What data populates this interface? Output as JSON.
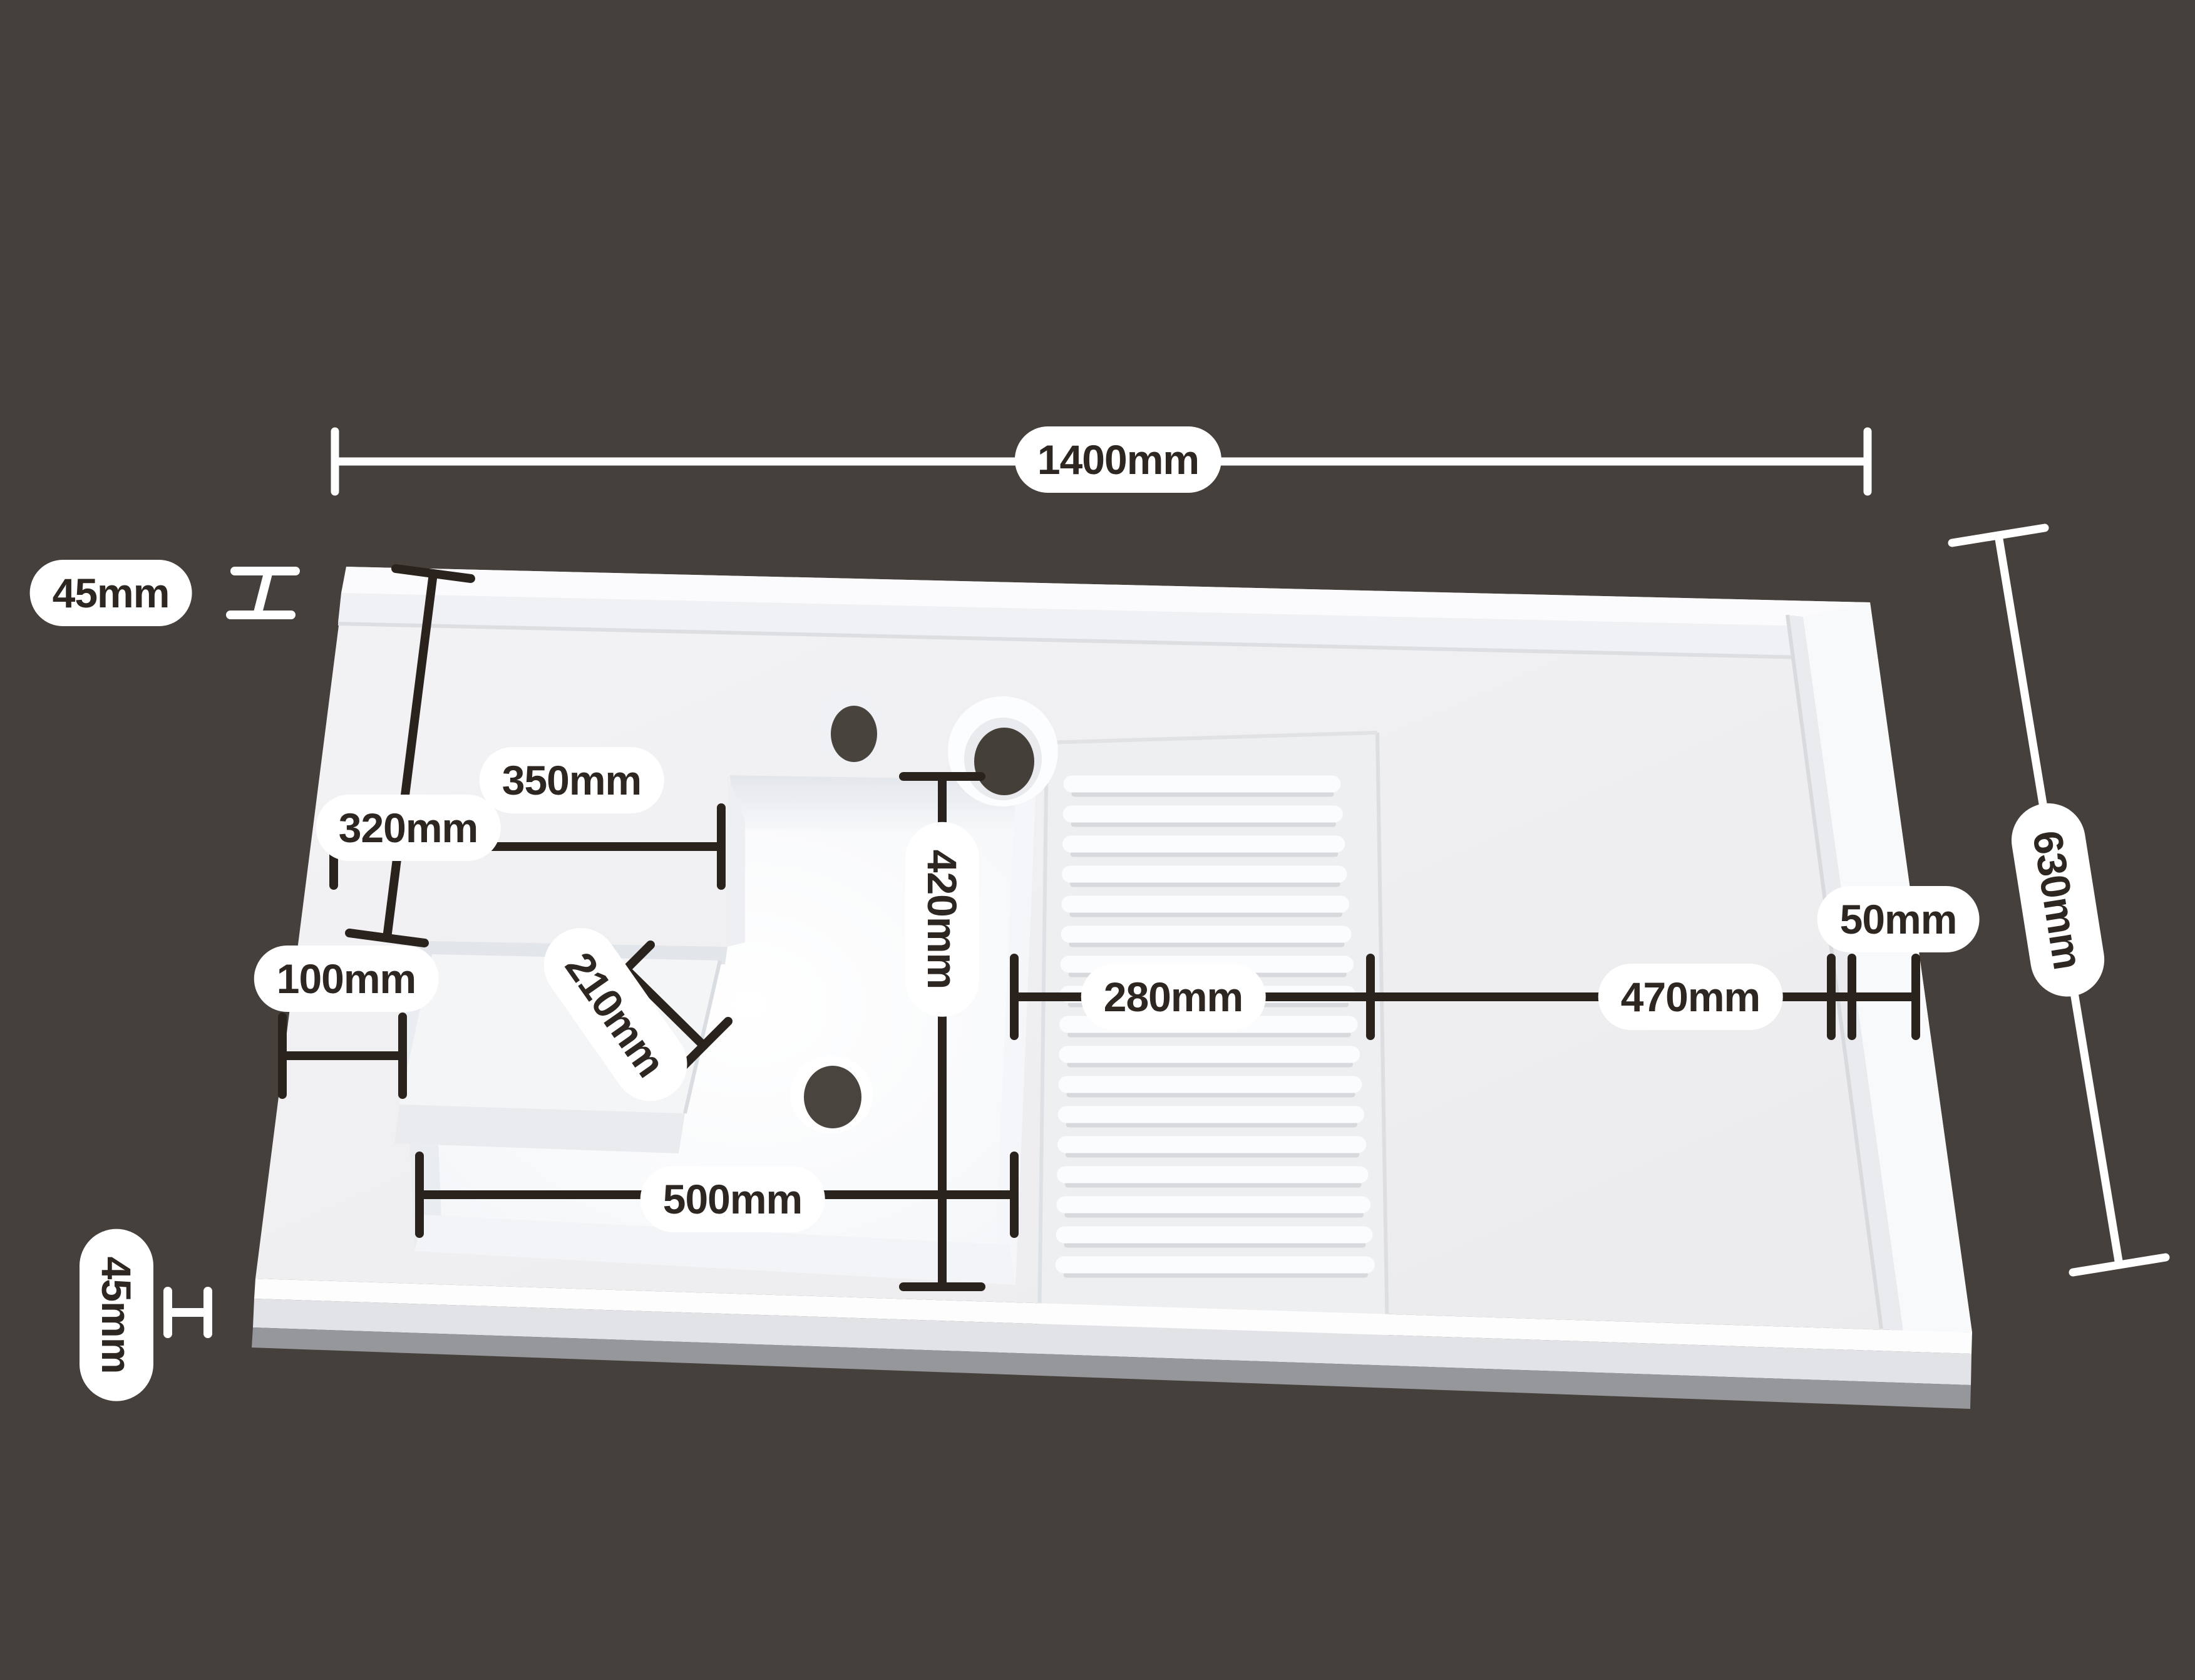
{
  "page": {
    "title": "Sink dimension diagram"
  },
  "colors": {
    "background": "#45403b",
    "pill_background": "#ffffff",
    "pill_text": "#2d2621",
    "dimension_line_dark": "#2a221c",
    "dimension_line_light": "#ffffff"
  },
  "product": {
    "name": "laundry-sink-with-washboard-and-drainboard",
    "washboard_ridge_count": 17,
    "faucet_hole_count": 2,
    "drain_hole_count": 1
  },
  "dimensions": {
    "overall_width": "1400mm",
    "top_edge_thickness": "45mm",
    "deck_width": "350mm",
    "deck_depth": "320mm",
    "left_rim_width": "100mm",
    "step_depth": "210mm",
    "bowl_depth": "420mm",
    "bowl_width": "500mm",
    "washboard_width": "280mm",
    "drainboard_width": "470mm",
    "right_rim_width": "50mm",
    "overall_depth": "630mm",
    "bottom_edge_thickness": "45mm"
  }
}
